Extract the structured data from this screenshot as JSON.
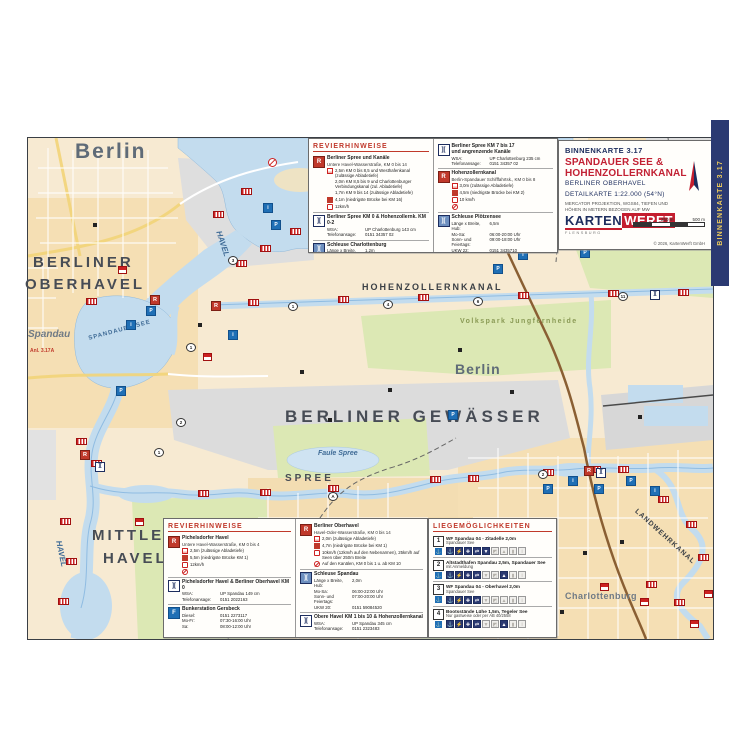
{
  "colors": {
    "accent_red": "#c0392b",
    "navy": "#2b3a72",
    "logo_red": "#c41e2f",
    "water": "#c3dcee",
    "water_deep": "#a9cde8",
    "park": "#dce8b4",
    "urban": "#f6e8cc",
    "grey_area": "#dedede",
    "banner_gold": "#e9c85c"
  },
  "banner": {
    "text": "BINNENKARTE 3.17"
  },
  "title_block": {
    "series": "BINNENKARTE 3.17",
    "title": "SPANDAUER SEE & HOHENZOLLERNKANAL",
    "subtitle": "BERLINER OBERHAVEL",
    "detail": "DETAILKARTE 1:22.000 (54°N)",
    "projection": "MERCATOR PROJEKTION, WGS84, TIEFEN UND HÖHEN IN METERN BEZOGEN AUF MW",
    "logo_part1": "KARTEN",
    "logo_part2": "WERFT",
    "logo_sub": "FLENSBURG",
    "scale_250": "250 m",
    "scale_500": "500 m",
    "copyright": "© 2026, KartenWerft GmbH"
  },
  "legend_top": {
    "heading": "REVIERHINWEISE",
    "col1": {
      "entries": [
        {
          "badge": "R",
          "title": "Berliner Spree und Kanäle",
          "subtitle": "Untere Havel-Wasserstraße, KM 0 bis 14",
          "info": [
            {
              "ic": "depth",
              "t": "2,5m KM 0 bis 8,5 und Westhafenkanal (zulässige Abladetiefe)"
            },
            {
              "ic": "none",
              "t": "2,0m KM 8,5 bis 9 und Charlottenburger Verbindungskanal (zul. Abladetiefe)"
            },
            {
              "ic": "none",
              "t": "1,7m KM 9 bis 14 (zulässige Abladetiefe)"
            },
            {
              "ic": "bridge",
              "t": "4,1m (niedrigste Brücke bei KM 16)"
            },
            {
              "ic": "speed",
              "t": "12km/h"
            }
          ]
        },
        {
          "badge": "lock",
          "title": "Berliner Spree KM 0 & Hohenzollernk. KM 0-2",
          "kv": [
            [
              "WSA:",
              "UP Charlottenburg 143 cm"
            ],
            [
              "Telefonansage:",
              "0151 34357 02"
            ]
          ]
        },
        {
          "badge": "gate",
          "title": "Schleuse Charlottenburg",
          "kv": [
            [
              "Länge x Breite, Hub:",
              "1,2m"
            ],
            [
              "Mo-Sa:",
              "06:00-22:00 Uhr"
            ],
            [
              "Sonn- und Feiertags:",
              "08:00-20:00 Uhr"
            ],
            [
              "UKW 82",
              "—"
            ]
          ]
        }
      ]
    },
    "col2": {
      "entries": [
        {
          "badge": "lock",
          "title": "Berliner Spree KM 7 bis 17",
          "title2": "und angrenzende Kanäle",
          "kv": [
            [
              "WSA:",
              "UP Charlottenburg 235 cm"
            ],
            [
              "Telefonansage:",
              "0151 34357 02"
            ]
          ]
        },
        {
          "badge": "R",
          "title": "Hohenzollernkanal",
          "subtitle": "Berlin-Spandauer Schifffahrtsk., KM 0 bis 8",
          "info": [
            {
              "ic": "depth",
              "t": "3,0m (zulässige Abladetiefe)"
            },
            {
              "ic": "bridge",
              "t": "4,5m (niedrigste Brücke bei KM 2)"
            },
            {
              "ic": "speed",
              "t": "10 km/h"
            },
            {
              "ic": "ban",
              "t": ""
            }
          ]
        },
        {
          "badge": "gate",
          "title": "Schleuse Plötzensee",
          "kv": [
            [
              "Länge x Breite, Hub:",
              "6,5m"
            ],
            [
              "Mo-Sa:",
              "06:00-20:00 Uhr"
            ],
            [
              "Sonn- und Feiertags:",
              "09:00-18:00 Uhr"
            ],
            [
              "UKW 22:",
              "0151 3435710"
            ]
          ]
        }
      ]
    }
  },
  "legend_bottom": {
    "heading": "REVIERHINWEISE",
    "col1": {
      "entries": [
        {
          "badge": "R",
          "title": "Pichelsdorfer Havel",
          "subtitle": "Untere Havel-Wasserstraße, KM 0 bis 4",
          "info": [
            {
              "ic": "depth",
              "t": "2,5m (zulässige Abladetiefe)"
            },
            {
              "ic": "bridge",
              "t": "5,5m (niedrigste Brücke KM 1)"
            },
            {
              "ic": "speed",
              "t": "12km/h"
            },
            {
              "ic": "ban",
              "t": ""
            }
          ]
        },
        {
          "badge": "lock",
          "title": "Pichelsdorfer Havel & Berliner Oberhavel KM 0",
          "kv": [
            [
              "WSA:",
              "UP Spandau 149 cm"
            ],
            [
              "Telefonansage:",
              "0151 2022163"
            ]
          ]
        },
        {
          "badge": "fuel",
          "title": "Bunkerstation Gersbeck",
          "kv": [
            [
              "Diesel:",
              "0151 2273117"
            ],
            [
              "Mo-Fr:",
              "07:30-16:00 Uhr"
            ],
            [
              "Sa:",
              "08:00-12:00 Uhr"
            ]
          ]
        }
      ]
    },
    "col2": {
      "entries": [
        {
          "badge": "R",
          "title": "Berliner Oberhavel",
          "subtitle": "Havel-Oder-Wasserstraße, KM 0 bis 14",
          "info": [
            {
              "ic": "depth",
              "t": "2,0m (zulässige Abladetiefe)"
            },
            {
              "ic": "bridge",
              "t": "4,7m (niedrigste Brücke bei KM 1)"
            },
            {
              "ic": "speed",
              "t": "10km/h (12km/h auf den Nebenarmen), 25km/h auf Seen über 250m Breite"
            },
            {
              "ic": "ban",
              "t": "Auf den Kanälen, KM 0 bis 1 u. ab KM 10"
            }
          ]
        },
        {
          "badge": "gate",
          "title": "Schleuse Spandau",
          "kv": [
            [
              "Länge x Breite, Hub:",
              "2,0m"
            ],
            [
              "Mo-Sa:",
              "06:00-22:00 Uhr"
            ],
            [
              "Sonn- und Feiertags:",
              "07:00-20:00 Uhr"
            ],
            [
              "UKW 20:",
              "0151 59084520"
            ]
          ]
        },
        {
          "badge": "lock",
          "title": "Obere Havel KM 1 bis 10 & Hohenzollernkanal",
          "kv": [
            [
              "WSA:",
              "UP Spandau 345 cm"
            ],
            [
              "Telefonansage:",
              "0151 2323483"
            ]
          ]
        }
      ]
    }
  },
  "legend_moorings": {
    "heading": "LIEGEMÖGLICHKEITEN",
    "amenity_glyphs": [
      "⚓",
      "⚡",
      "✚",
      "⇄",
      "▼",
      "◩",
      "▲",
      "▮",
      "i"
    ],
    "entries": [
      {
        "num": "1",
        "title": "WF Spandau 04 - Zitadelle 2,0m",
        "sub": "Spandauer See",
        "on": [
          0,
          1,
          2,
          3,
          4
        ]
      },
      {
        "num": "2",
        "title": "Altstadthafen Spandau 2,5m, Spandauer See",
        "sub": "mit Anmeldung",
        "on": [
          0,
          1,
          2,
          3,
          6
        ]
      },
      {
        "num": "3",
        "title": "WF Spandau 04 - Oberhavel 2,0m",
        "sub": "Spandauer See",
        "on": [
          0,
          1,
          2,
          3
        ]
      },
      {
        "num": "4",
        "title": "Bootsstände Lühe 1,5m, Tegeler See",
        "sub": "Nur gastweise oder per AB 40/2558",
        "on": [
          0,
          1,
          2,
          3,
          6
        ]
      }
    ]
  },
  "map": {
    "labels": [
      {
        "t": "Berlin",
        "x": 75,
        "y": 141,
        "s": 21,
        "c": "#5f6b78",
        "sp": 2
      },
      {
        "t": "BERLINER",
        "x": 33,
        "y": 255,
        "s": 15,
        "c": "#474c55",
        "sp": 3
      },
      {
        "t": "OBERHAVEL",
        "x": 25,
        "y": 277,
        "s": 15,
        "c": "#474c55",
        "sp": 3
      },
      {
        "t": "Spandau",
        "x": 28,
        "y": 330,
        "s": 10,
        "c": "#6f7a85",
        "it": 1
      },
      {
        "t": "SPANDAUER SEE",
        "x": 88,
        "y": 336,
        "s": 6,
        "c": "#3f6b96",
        "sp": 1,
        "rot": -15
      },
      {
        "t": "HAVEL",
        "x": 222,
        "y": 230,
        "s": 8,
        "c": "#3f6b96",
        "rot": 72,
        "it": 1
      },
      {
        "t": "HAVEL",
        "x": 62,
        "y": 540,
        "s": 8,
        "c": "#3f6b96",
        "rot": 78,
        "it": 1
      },
      {
        "t": "HOHENZOLLERNKANAL",
        "x": 362,
        "y": 283,
        "s": 9,
        "c": "#3a3f45",
        "sp": 2
      },
      {
        "t": "Volkspark Jungfernheide",
        "x": 460,
        "y": 318,
        "s": 7,
        "c": "#8a9a55",
        "sp": 1.5
      },
      {
        "t": "Berlin",
        "x": 455,
        "y": 362,
        "s": 14,
        "c": "#5f6b78",
        "sp": 1
      },
      {
        "t": "BERLINER GEWÄSSER",
        "x": 285,
        "y": 408,
        "s": 17,
        "c": "#474c55",
        "sp": 4
      },
      {
        "t": "Faule Spree",
        "x": 318,
        "y": 450,
        "s": 7,
        "c": "#3f6b96",
        "it": 1
      },
      {
        "t": "SPREE",
        "x": 285,
        "y": 474,
        "s": 10,
        "c": "#474c55",
        "sp": 3
      },
      {
        "t": "MITTLERE",
        "x": 92,
        "y": 528,
        "s": 15,
        "c": "#474c55",
        "sp": 3
      },
      {
        "t": "HAVEL",
        "x": 103,
        "y": 551,
        "s": 15,
        "c": "#474c55",
        "sp": 3
      },
      {
        "t": "Charlottenburg",
        "x": 565,
        "y": 592,
        "s": 9,
        "c": "#6f7a85",
        "sp": 0.5
      },
      {
        "t": "LANDWEHRKANAL",
        "x": 638,
        "y": 508,
        "s": 7,
        "c": "#3a3f45",
        "sp": 1,
        "rot": 42
      },
      {
        "t": "Anl. 3.17A",
        "x": 30,
        "y": 349,
        "s": 5,
        "c": "#c0392b"
      }
    ],
    "blue_icons": [
      {
        "x": 263,
        "y": 203,
        "g": "i"
      },
      {
        "x": 271,
        "y": 220,
        "g": "P"
      },
      {
        "x": 353,
        "y": 206,
        "g": "P"
      },
      {
        "x": 418,
        "y": 194,
        "g": "i"
      },
      {
        "x": 453,
        "y": 203,
        "g": "P"
      },
      {
        "x": 518,
        "y": 206,
        "g": "i"
      },
      {
        "x": 543,
        "y": 220,
        "g": "P"
      },
      {
        "x": 570,
        "y": 226,
        "g": "i"
      },
      {
        "x": 580,
        "y": 248,
        "g": "P"
      },
      {
        "x": 518,
        "y": 250,
        "g": "i"
      },
      {
        "x": 493,
        "y": 264,
        "g": "P"
      },
      {
        "x": 146,
        "y": 306,
        "g": "P"
      },
      {
        "x": 126,
        "y": 320,
        "g": "i"
      },
      {
        "x": 116,
        "y": 386,
        "g": "P"
      },
      {
        "x": 228,
        "y": 330,
        "g": "i"
      },
      {
        "x": 543,
        "y": 484,
        "g": "P"
      },
      {
        "x": 568,
        "y": 476,
        "g": "i"
      },
      {
        "x": 594,
        "y": 484,
        "g": "P"
      },
      {
        "x": 626,
        "y": 476,
        "g": "P"
      },
      {
        "x": 650,
        "y": 486,
        "g": "i"
      },
      {
        "x": 448,
        "y": 410,
        "g": "P"
      }
    ],
    "bridges": [
      {
        "x": 248,
        "y": 299
      },
      {
        "x": 338,
        "y": 296
      },
      {
        "x": 418,
        "y": 294
      },
      {
        "x": 518,
        "y": 292
      },
      {
        "x": 608,
        "y": 290
      },
      {
        "x": 678,
        "y": 289
      },
      {
        "x": 198,
        "y": 490
      },
      {
        "x": 260,
        "y": 489
      },
      {
        "x": 328,
        "y": 485
      },
      {
        "x": 430,
        "y": 476
      },
      {
        "x": 468,
        "y": 475
      },
      {
        "x": 543,
        "y": 469
      },
      {
        "x": 590,
        "y": 466
      },
      {
        "x": 618,
        "y": 466
      },
      {
        "x": 658,
        "y": 496
      },
      {
        "x": 686,
        "y": 521
      },
      {
        "x": 698,
        "y": 554
      },
      {
        "x": 646,
        "y": 581
      },
      {
        "x": 674,
        "y": 599
      },
      {
        "x": 86,
        "y": 298
      },
      {
        "x": 76,
        "y": 438
      },
      {
        "x": 91,
        "y": 460
      },
      {
        "x": 60,
        "y": 518
      },
      {
        "x": 66,
        "y": 558
      },
      {
        "x": 58,
        "y": 598
      },
      {
        "x": 213,
        "y": 211
      },
      {
        "x": 241,
        "y": 188
      },
      {
        "x": 260,
        "y": 245
      },
      {
        "x": 290,
        "y": 228
      },
      {
        "x": 236,
        "y": 260
      }
    ],
    "prohibitions": [
      {
        "x": 453,
        "y": 228
      },
      {
        "x": 530,
        "y": 165
      },
      {
        "x": 560,
        "y": 150
      },
      {
        "x": 586,
        "y": 188
      },
      {
        "x": 638,
        "y": 196
      },
      {
        "x": 698,
        "y": 178
      },
      {
        "x": 706,
        "y": 205
      },
      {
        "x": 418,
        "y": 184
      },
      {
        "x": 268,
        "y": 158
      }
    ],
    "numbers": [
      {
        "x": 288,
        "y": 302,
        "n": "1"
      },
      {
        "x": 383,
        "y": 300,
        "n": "4"
      },
      {
        "x": 473,
        "y": 297,
        "n": "6"
      },
      {
        "x": 618,
        "y": 292,
        "n": "11"
      },
      {
        "x": 328,
        "y": 492,
        "n": "A"
      },
      {
        "x": 228,
        "y": 256,
        "n": "3"
      },
      {
        "x": 186,
        "y": 343,
        "n": "1"
      },
      {
        "x": 176,
        "y": 418,
        "n": "2"
      },
      {
        "x": 154,
        "y": 448,
        "n": "1"
      },
      {
        "x": 538,
        "y": 470,
        "n": "2"
      }
    ],
    "red_badges": [
      {
        "x": 211,
        "y": 301
      },
      {
        "x": 80,
        "y": 450
      },
      {
        "x": 584,
        "y": 466
      },
      {
        "x": 150,
        "y": 295
      }
    ],
    "houses": [
      {
        "x": 418,
        "y": 595
      },
      {
        "x": 456,
        "y": 600
      },
      {
        "x": 600,
        "y": 583
      },
      {
        "x": 640,
        "y": 598
      },
      {
        "x": 690,
        "y": 620
      },
      {
        "x": 704,
        "y": 590
      },
      {
        "x": 135,
        "y": 518
      },
      {
        "x": 118,
        "y": 266
      },
      {
        "x": 203,
        "y": 353
      }
    ],
    "locks": [
      {
        "x": 95,
        "y": 462
      },
      {
        "x": 596,
        "y": 468
      },
      {
        "x": 650,
        "y": 290
      }
    ],
    "buildings": [
      {
        "x": 93,
        "y": 223
      },
      {
        "x": 198,
        "y": 323
      },
      {
        "x": 328,
        "y": 418
      },
      {
        "x": 638,
        "y": 415
      },
      {
        "x": 583,
        "y": 551
      },
      {
        "x": 348,
        "y": 556
      },
      {
        "x": 246,
        "y": 518
      },
      {
        "x": 458,
        "y": 348
      },
      {
        "x": 673,
        "y": 233
      },
      {
        "x": 388,
        "y": 388
      },
      {
        "x": 300,
        "y": 370
      },
      {
        "x": 510,
        "y": 390
      },
      {
        "x": 620,
        "y": 540
      },
      {
        "x": 560,
        "y": 610
      },
      {
        "x": 250,
        "y": 600
      }
    ]
  }
}
